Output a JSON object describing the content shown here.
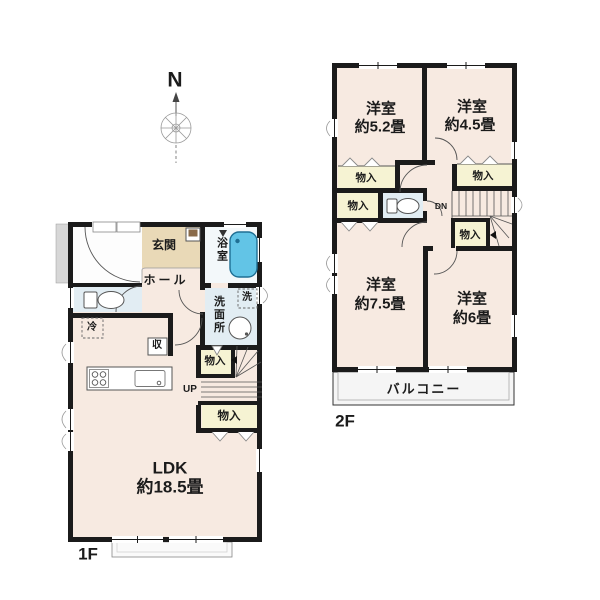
{
  "compass": {
    "north": "N"
  },
  "floor1": {
    "label": "1F",
    "ldk": {
      "name": "LDK",
      "size": "約18.5畳"
    },
    "entrance": "玄関",
    "hall": "ホール",
    "bath": "浴室",
    "washroom": "洗面所",
    "washer": "洗",
    "fridge": "冷",
    "storage": "収",
    "closet_a": "物入",
    "closet_b": "物入",
    "stairs": "UP"
  },
  "floor2": {
    "label": "2F",
    "bedroom_nw": {
      "name": "洋室",
      "size": "約5.2畳"
    },
    "bedroom_ne": {
      "name": "洋室",
      "size": "約4.5畳"
    },
    "bedroom_sw": {
      "name": "洋室",
      "size": "約7.5畳"
    },
    "bedroom_se": {
      "name": "洋室",
      "size": "約6畳"
    },
    "closet_a": "物入",
    "closet_b": "物入",
    "closet_c": "物入",
    "closet_d": "物入",
    "stairs": "DN",
    "balcony": "バルコニー"
  },
  "colors": {
    "wall": "#1b1b1b",
    "room": "#f7eae1",
    "closet": "#f6f3d3",
    "wet": "#e2edf3",
    "genkan": "#e9d9b7",
    "tub": "#62c4e6",
    "porch": "#d7d7d7",
    "balcony": "#f5f5f5",
    "bathfloor": "#f3f8fa"
  }
}
